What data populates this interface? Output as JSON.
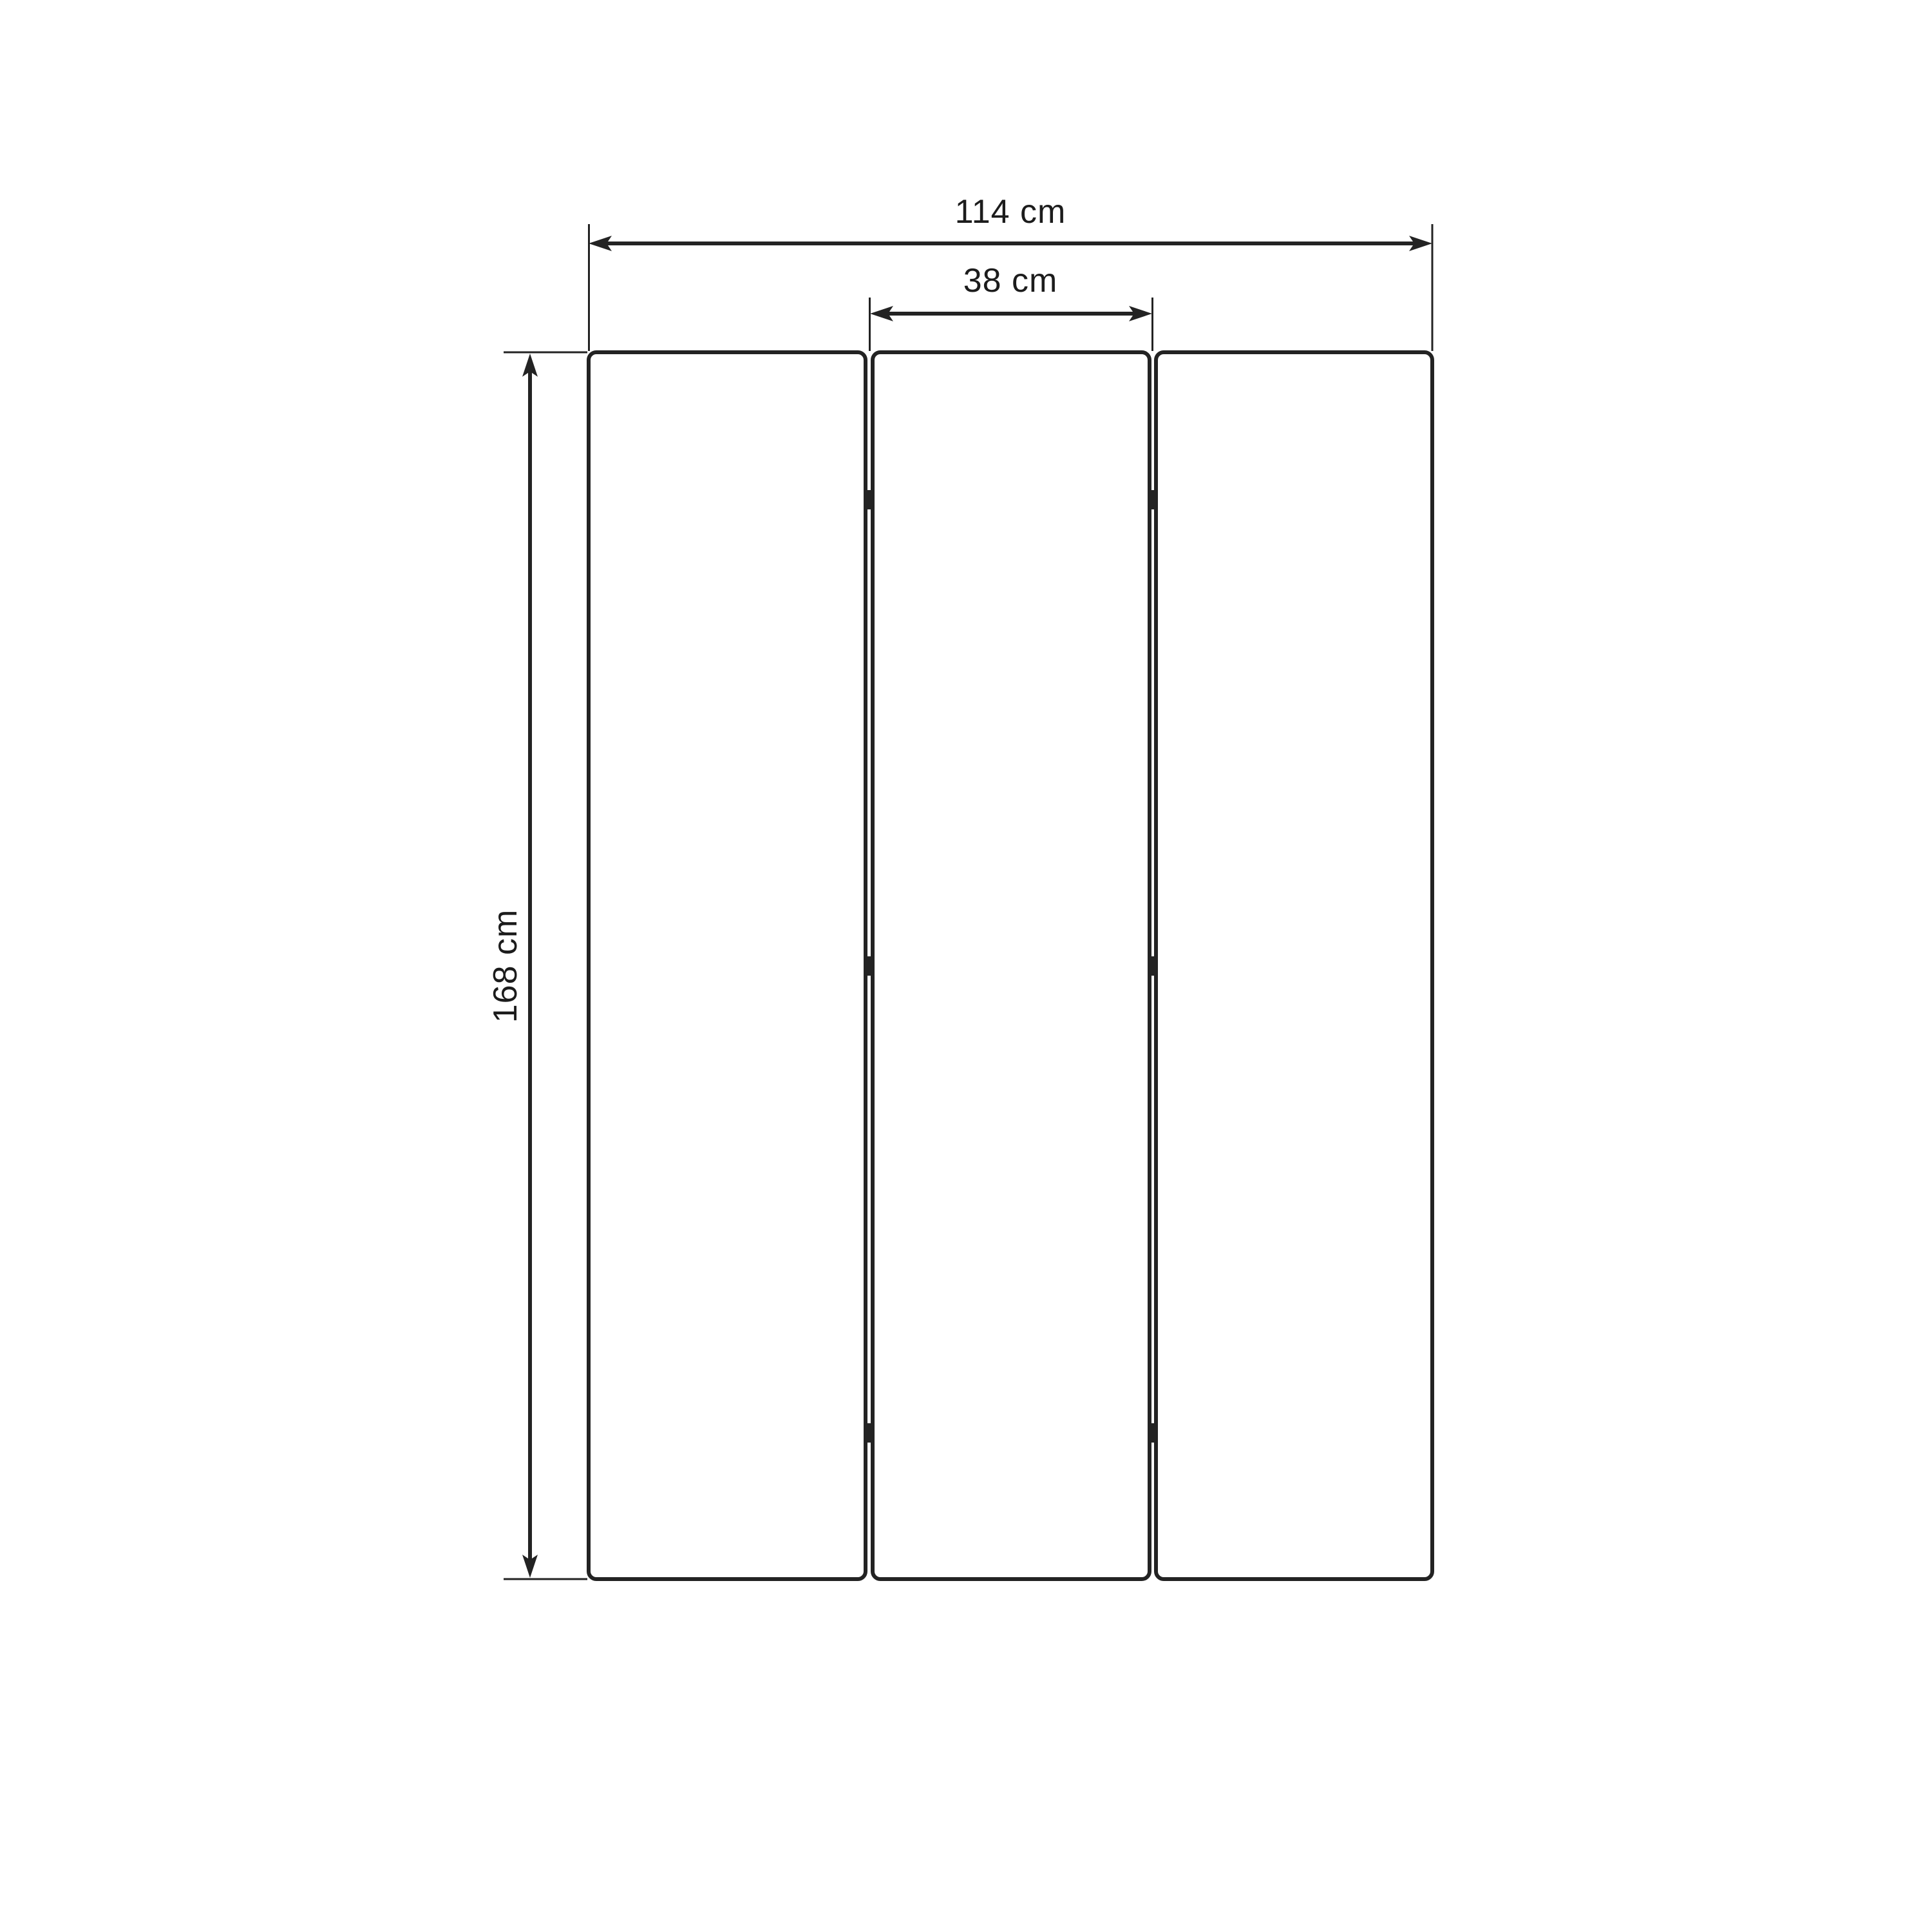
{
  "drawing": {
    "type": "dimensioned technical drawing of a 3-panel folding screen (front view)",
    "labels": {
      "total_width": "114 cm",
      "panel_width": "38 cm",
      "height": "168 cm"
    },
    "values": {
      "total_width_cm": 114,
      "panel_width_cm": 38,
      "height_cm": 168,
      "unit": "cm"
    },
    "panels": {
      "count": 3,
      "hinges_per_gap": 3
    },
    "colors": {
      "line": "#232323",
      "background": "#ffffff"
    }
  }
}
